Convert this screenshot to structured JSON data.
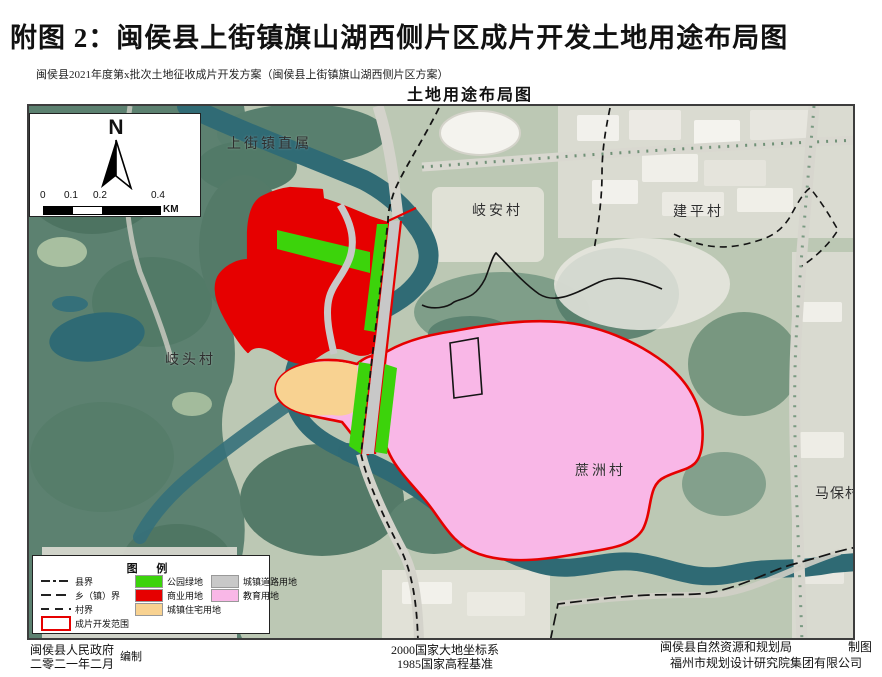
{
  "page": {
    "title": "附图 2：闽侯县上街镇旗山湖西侧片区成片开发土地用途布局图",
    "subtitle": "闽侯县2021年度第x批次土地征收成片开发方案（闽侯县上街镇旗山湖西侧片区方案）",
    "map_title": "土地用途布局图"
  },
  "compass": {
    "north_label": "N"
  },
  "scalebar": {
    "ticks": [
      "0",
      "0.1",
      "0.2",
      "0.4"
    ],
    "unit": "KM"
  },
  "map": {
    "labels": [
      {
        "text": "上街镇直属"
      },
      {
        "text": "岐安村"
      },
      {
        "text": "建平村"
      },
      {
        "text": "岐头村"
      },
      {
        "text": "蔗洲村"
      },
      {
        "text": "马保村"
      }
    ]
  },
  "legend": {
    "title": "图  例",
    "line_items": [
      {
        "label": "县界",
        "style": "dashdot"
      },
      {
        "label": "乡（镇）界",
        "style": "longdash"
      },
      {
        "label": "村界",
        "style": "dash"
      }
    ],
    "boundary_item": {
      "label": "成片开发范围",
      "color": "#e60000"
    },
    "fill_items": [
      {
        "label": "公园绿地",
        "color": "#3cd30b"
      },
      {
        "label": "商业用地",
        "color": "#e60000"
      },
      {
        "label": "城镇住宅用地",
        "color": "#f8d291"
      },
      {
        "label": "城镇道路用地",
        "color": "#c8c8c8"
      },
      {
        "label": "教育用地",
        "color": "#f9b7e7"
      }
    ]
  },
  "footer": {
    "left_line1": "闽侯县人民政府",
    "left_line2": "二零二一年二月",
    "left_role": "编制",
    "center_line1": "2000国家大地坐标系",
    "center_line2": "1985国家高程基准",
    "right_line1": "闽侯县自然资源和规划局",
    "right_role": "制图",
    "right_line2": "福州市规划设计研究院集团有限公司"
  }
}
